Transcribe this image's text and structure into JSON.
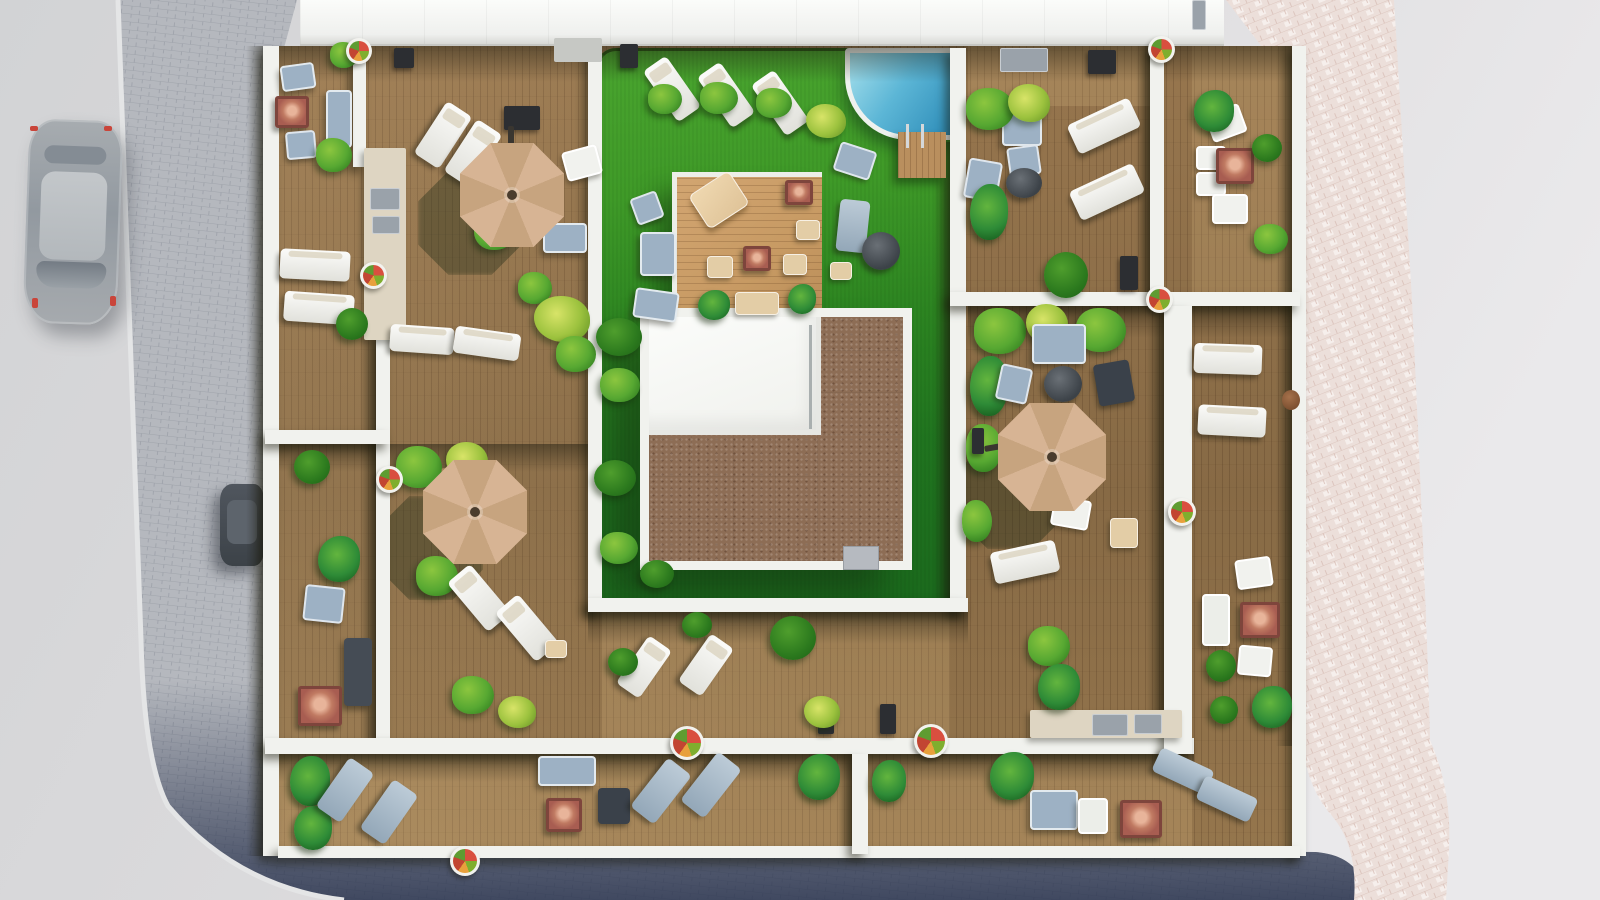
{
  "scene": {
    "description": "Aerial 3D architectural rendering of a residential rooftop terrace plan: central green lawn with swimming pool and wood platform, stair-core roof with gravel border, wooden deck terraces divided by white walls, parasols, loungers and plants; surrounding streets with two parked cars.",
    "umbrella_count": 3,
    "car_count": 2,
    "pool_count": 1
  },
  "palette": {
    "pavement": "#d6d6d8",
    "pavement2": "#e8e7e9",
    "brick": "#b5b8be",
    "brickLine": "#9fa3ab",
    "pinkPave": "#ecdfda",
    "pinkLine": "#d9bfb7",
    "roadShadow": "#232d49",
    "curb": "#e4e5e6",
    "wood": "#8d6f4a",
    "woodLight": "#c79a63",
    "wall": "#f1f2ee",
    "lawnTop": "#4aa52f",
    "lawnBottom": "#1b6a1d",
    "poolLight": "#9fdcea",
    "poolDeep": "#2d8cb8",
    "gravel": "#8d6d55",
    "canopy": "#d7b494",
    "canopy2": "#c7a47f",
    "blueGray": "#9db1c4",
    "fire": "#a85d51",
    "plant": "#57a832",
    "palm": "#2e8b37",
    "beige": "#e3cda6"
  },
  "items": [
    [
      "lp",
      265,
      754,
      927,
      92
    ],
    [
      "lp",
      1192,
      46,
      114,
      246
    ],
    [
      "lp",
      602,
      612,
      348,
      126
    ],
    [
      "lp",
      968,
      46,
      182,
      60
    ],
    [
      "ush",
      418,
      171,
      104,
      104
    ],
    [
      "ush",
      379,
      496,
      104,
      104
    ],
    [
      "ush",
      956,
      441,
      108,
      108
    ],
    [
      "sh",
      278,
      46,
      1014,
      36
    ],
    [
      "sh",
      265,
      444,
      125,
      28
    ],
    [
      "sh",
      390,
      444,
      212,
      28
    ],
    [
      "sh",
      968,
      306,
      332,
      32
    ],
    [
      "sh",
      588,
      612,
      380,
      32
    ],
    [
      "sh",
      265,
      754,
      929,
      28
    ],
    [
      "shv",
      360,
      335,
      17,
      403
    ],
    [
      "shv",
      1146,
      306,
      19,
      448
    ],
    [
      "shv",
      933,
      142,
      18,
      456
    ],
    [
      "shv",
      1136,
      46,
      15,
      246
    ],
    [
      "shv",
      838,
      754,
      15,
      102
    ],
    [
      "shv",
      246,
      46,
      18,
      810
    ],
    [
      "shv",
      1276,
      46,
      17,
      700
    ],
    [
      "wall",
      263,
      46,
      16,
      810
    ],
    [
      "wall",
      1292,
      46,
      14,
      810
    ],
    [
      "wall",
      278,
      846,
      1022,
      12
    ],
    [
      "wall",
      588,
      48,
      14,
      564
    ],
    [
      "wall",
      950,
      48,
      16,
      564
    ],
    [
      "wall",
      588,
      598,
      380,
      14
    ],
    [
      "wall",
      376,
      335,
      14,
      403
    ],
    [
      "wall",
      265,
      430,
      125,
      14
    ],
    [
      "wall",
      265,
      738,
      929,
      16
    ],
    [
      "wall",
      852,
      754,
      16,
      100
    ],
    [
      "wall",
      950,
      292,
      350,
      14
    ],
    [
      "wall",
      1150,
      46,
      14,
      246
    ],
    [
      "wall",
      1164,
      306,
      28,
      448
    ],
    [
      "wall",
      353,
      46,
      13,
      121
    ],
    [
      "cnt",
      364,
      148,
      42,
      192
    ],
    [
      "kit",
      370,
      188,
      30,
      22
    ],
    [
      "kit",
      372,
      216,
      28,
      18
    ],
    [
      "cnt",
      1030,
      710,
      152,
      28
    ],
    [
      "kit",
      1092,
      714,
      36,
      22
    ],
    [
      "kit",
      1134,
      714,
      28,
      20
    ],
    [
      "kit",
      1000,
      48,
      48,
      24
    ],
    [
      "grill",
      1088,
      50,
      28,
      24
    ],
    [
      "pad",
      554,
      38,
      48,
      24
    ],
    [
      "grill",
      620,
      44,
      18,
      24
    ],
    [
      "grill",
      504,
      106,
      36,
      24
    ],
    [
      "grill",
      818,
      704,
      16,
      30
    ],
    [
      "grill",
      880,
      704,
      16,
      30
    ],
    [
      "grill",
      1120,
      256,
      18,
      34
    ],
    [
      "grill",
      394,
      48,
      20,
      20
    ],
    [
      "box",
      843,
      546,
      36,
      24
    ],
    [
      "pot",
      1282,
      390,
      18,
      20
    ],
    [
      "kit",
      1192,
      0,
      14,
      30
    ],
    [
      "deckpad",
      898,
      132,
      48,
      46
    ],
    [
      "ladder",
      906,
      124,
      18,
      24
    ],
    [
      "sf",
      281,
      64,
      34,
      26,
      -8
    ],
    [
      "sf",
      326,
      90,
      26,
      58
    ],
    [
      "fire",
      275,
      96,
      34,
      32
    ],
    [
      "ch",
      286,
      131,
      30,
      28,
      -5
    ],
    [
      "pl",
      316,
      138,
      36,
      34
    ],
    [
      "pl",
      330,
      42,
      28,
      26
    ],
    [
      "lw",
      280,
      250,
      70,
      30,
      3
    ],
    [
      "lw",
      284,
      293,
      70,
      30,
      4
    ],
    [
      "lw",
      428,
      104,
      30,
      62,
      33
    ],
    [
      "lw",
      458,
      122,
      30,
      62,
      33
    ],
    [
      "chw",
      564,
      148,
      36,
      30,
      -15
    ],
    [
      "sf",
      543,
      223,
      44,
      30
    ],
    [
      "lw",
      390,
      326,
      64,
      27,
      4
    ],
    [
      "lw",
      454,
      330,
      66,
      27,
      8
    ],
    [
      "pl",
      474,
      210,
      42,
      40
    ],
    [
      "pl",
      518,
      272,
      34,
      32
    ],
    [
      "ply",
      534,
      296,
      56,
      46
    ],
    [
      "bsh",
      336,
      308,
      32,
      32
    ],
    [
      "pl",
      556,
      336,
      40,
      36
    ],
    [
      "bsh",
      294,
      450,
      36,
      34
    ],
    [
      "plm",
      318,
      536,
      42,
      46
    ],
    [
      "ch",
      304,
      586,
      40,
      36,
      6
    ],
    [
      "sfd",
      344,
      638,
      28,
      68
    ],
    [
      "fire",
      298,
      686,
      44,
      40
    ],
    [
      "cht",
      428,
      468,
      36,
      30,
      -12
    ],
    [
      "pl",
      396,
      446,
      46,
      42
    ],
    [
      "ply",
      446,
      442,
      42,
      38
    ],
    [
      "pl",
      416,
      556,
      42,
      40
    ],
    [
      "lw",
      464,
      566,
      30,
      64,
      -40
    ],
    [
      "lw",
      512,
      596,
      30,
      64,
      -40
    ],
    [
      "pouf",
      545,
      640,
      22,
      18
    ],
    [
      "pl",
      452,
      676,
      42,
      38
    ],
    [
      "ply",
      498,
      696,
      38,
      32
    ],
    [
      "plm",
      290,
      756,
      40,
      50
    ],
    [
      "plm",
      294,
      806,
      38,
      44
    ],
    [
      "lb",
      330,
      760,
      30,
      60,
      35
    ],
    [
      "lb",
      374,
      782,
      30,
      60,
      35
    ],
    [
      "sf",
      538,
      756,
      58,
      30
    ],
    [
      "chd",
      598,
      788,
      32,
      36
    ],
    [
      "fire",
      546,
      798,
      36,
      34
    ],
    [
      "lb",
      646,
      760,
      30,
      62,
      38
    ],
    [
      "lb",
      696,
      754,
      30,
      62,
      38
    ],
    [
      "plm",
      798,
      754,
      42,
      46
    ],
    [
      "plm",
      872,
      760,
      34,
      42
    ],
    [
      "plm",
      990,
      752,
      44,
      48
    ],
    [
      "sf",
      1030,
      790,
      48,
      40
    ],
    [
      "sfw",
      1078,
      798,
      30,
      36
    ],
    [
      "fire",
      1120,
      800,
      42,
      38
    ],
    [
      "lb",
      1154,
      758,
      58,
      26,
      25
    ],
    [
      "lb",
      1198,
      786,
      58,
      26,
      25
    ],
    [
      "lw",
      630,
      638,
      28,
      58,
      35
    ],
    [
      "lw",
      692,
      636,
      28,
      58,
      35
    ],
    [
      "bsh",
      682,
      612,
      30,
      26
    ],
    [
      "bsh",
      770,
      616,
      46,
      44
    ],
    [
      "ply",
      804,
      696,
      36,
      32
    ],
    [
      "bsh",
      608,
      648,
      30,
      28
    ],
    [
      "lw",
      658,
      58,
      28,
      62,
      -35
    ],
    [
      "lw",
      712,
      64,
      28,
      62,
      -35
    ],
    [
      "lw",
      766,
      72,
      28,
      62,
      -35
    ],
    [
      "pl",
      648,
      84,
      34,
      30
    ],
    [
      "pl",
      700,
      82,
      38,
      32
    ],
    [
      "pl",
      756,
      88,
      36,
      30
    ],
    [
      "ply",
      806,
      104,
      40,
      34
    ],
    [
      "ch",
      633,
      194,
      28,
      28,
      -20
    ],
    [
      "sf",
      640,
      232,
      36,
      44
    ],
    [
      "sf",
      634,
      290,
      44,
      30,
      8
    ],
    [
      "ch",
      836,
      146,
      38,
      30,
      18
    ],
    [
      "lb",
      838,
      200,
      30,
      52,
      6
    ],
    [
      "tbl",
      862,
      232,
      38,
      38
    ],
    [
      "pouf",
      830,
      262,
      22,
      18
    ],
    [
      "bsh",
      596,
      318,
      46,
      38
    ],
    [
      "pl",
      600,
      368,
      40,
      34
    ],
    [
      "bsh",
      594,
      460,
      42,
      36
    ],
    [
      "pl",
      600,
      532,
      38,
      32
    ],
    [
      "bsh",
      640,
      560,
      34,
      28
    ],
    [
      "loungerT",
      695,
      180,
      48,
      40,
      -33
    ],
    [
      "fire",
      785,
      180,
      28,
      25
    ],
    [
      "pouf",
      796,
      220,
      24,
      20
    ],
    [
      "fire",
      743,
      246,
      28,
      25
    ],
    [
      "pouf",
      707,
      256,
      26,
      22
    ],
    [
      "pouf",
      783,
      254,
      24,
      21
    ],
    [
      "pouf",
      735,
      292,
      44,
      23
    ],
    [
      "plm",
      698,
      290,
      32,
      30
    ],
    [
      "plm",
      788,
      284,
      28,
      30
    ],
    [
      "pl",
      974,
      308,
      52,
      46
    ],
    [
      "ply",
      1026,
      304,
      42,
      40
    ],
    [
      "pl",
      1076,
      308,
      50,
      44
    ],
    [
      "plm",
      970,
      356,
      38,
      60
    ],
    [
      "pl",
      966,
      424,
      36,
      48
    ],
    [
      "sf",
      1032,
      324,
      54,
      40
    ],
    [
      "tbl",
      1044,
      366,
      38,
      36
    ],
    [
      "ch",
      998,
      366,
      32,
      36,
      12
    ],
    [
      "chd",
      1096,
      362,
      36,
      42,
      -10
    ],
    [
      "chw",
      1052,
      498,
      38,
      30,
      10
    ],
    [
      "pouf",
      1110,
      518,
      28,
      30
    ],
    [
      "lw",
      992,
      546,
      66,
      32,
      -12
    ],
    [
      "pl",
      1028,
      626,
      42,
      40
    ],
    [
      "plm",
      1038,
      664,
      42,
      46
    ],
    [
      "pl",
      962,
      500,
      30,
      42
    ],
    [
      "sf",
      1002,
      102,
      40,
      44
    ],
    [
      "ch",
      1008,
      146,
      32,
      30,
      -8
    ],
    [
      "tbl",
      1006,
      168,
      36,
      30
    ],
    [
      "ch",
      966,
      160,
      34,
      40,
      10
    ],
    [
      "lw",
      1070,
      110,
      68,
      32,
      -25
    ],
    [
      "lw",
      1072,
      176,
      70,
      32,
      -25
    ],
    [
      "pl",
      966,
      88,
      48,
      42
    ],
    [
      "ply",
      1008,
      84,
      42,
      38
    ],
    [
      "plm",
      970,
      184,
      38,
      56
    ],
    [
      "bsh",
      1044,
      252,
      44,
      46
    ],
    [
      "chw",
      1208,
      108,
      36,
      30,
      -20
    ],
    [
      "chw",
      1196,
      146,
      30,
      24
    ],
    [
      "chw",
      1196,
      172,
      30,
      24
    ],
    [
      "fire",
      1216,
      148,
      38,
      36
    ],
    [
      "chw",
      1212,
      194,
      36,
      30
    ],
    [
      "plm",
      1194,
      90,
      40,
      42
    ],
    [
      "bsh",
      1252,
      134,
      30,
      28
    ],
    [
      "pl",
      1254,
      224,
      34,
      30
    ],
    [
      "lw",
      1194,
      344,
      68,
      30,
      2
    ],
    [
      "lw",
      1198,
      406,
      68,
      30,
      3
    ],
    [
      "chw",
      1236,
      558,
      36,
      30,
      -8
    ],
    [
      "sfw",
      1202,
      594,
      28,
      52
    ],
    [
      "fire",
      1240,
      602,
      40,
      36
    ],
    [
      "chw",
      1238,
      646,
      34,
      30,
      5
    ],
    [
      "bsh",
      1206,
      650,
      30,
      32
    ],
    [
      "bsh",
      1210,
      696,
      28,
      28
    ],
    [
      "plm",
      1252,
      686,
      40,
      42
    ],
    [
      "fp",
      346,
      38,
      26,
      26
    ],
    [
      "fp",
      360,
      262,
      27,
      27
    ],
    [
      "fp",
      376,
      466,
      27,
      27
    ],
    [
      "fp",
      670,
      726,
      34,
      34
    ],
    [
      "fp",
      914,
      724,
      34,
      34
    ],
    [
      "fp",
      1148,
      36,
      27,
      27
    ],
    [
      "fp",
      1146,
      286,
      27,
      27
    ],
    [
      "fp",
      1168,
      498,
      28,
      28
    ],
    [
      "fp",
      450,
      846,
      30,
      30
    ],
    [
      "grill",
      972,
      428,
      12,
      26
    ],
    [
      "arm",
      508,
      126,
      6,
      70
    ],
    [
      "arm",
      424,
      494,
      54,
      6,
      -12
    ],
    [
      "arm",
      984,
      440,
      70,
      6,
      -10
    ],
    [
      "umb",
      460,
      143,
      104,
      104
    ],
    [
      "umb",
      423,
      460,
      104,
      104
    ],
    [
      "umb",
      998,
      403,
      108,
      108
    ],
    [
      "dot",
      30,
      126,
      8,
      5
    ],
    [
      "dot",
      104,
      126,
      8,
      5
    ],
    [
      "dot",
      32,
      298,
      6,
      10
    ],
    [
      "dot",
      110,
      296,
      6,
      10
    ]
  ]
}
